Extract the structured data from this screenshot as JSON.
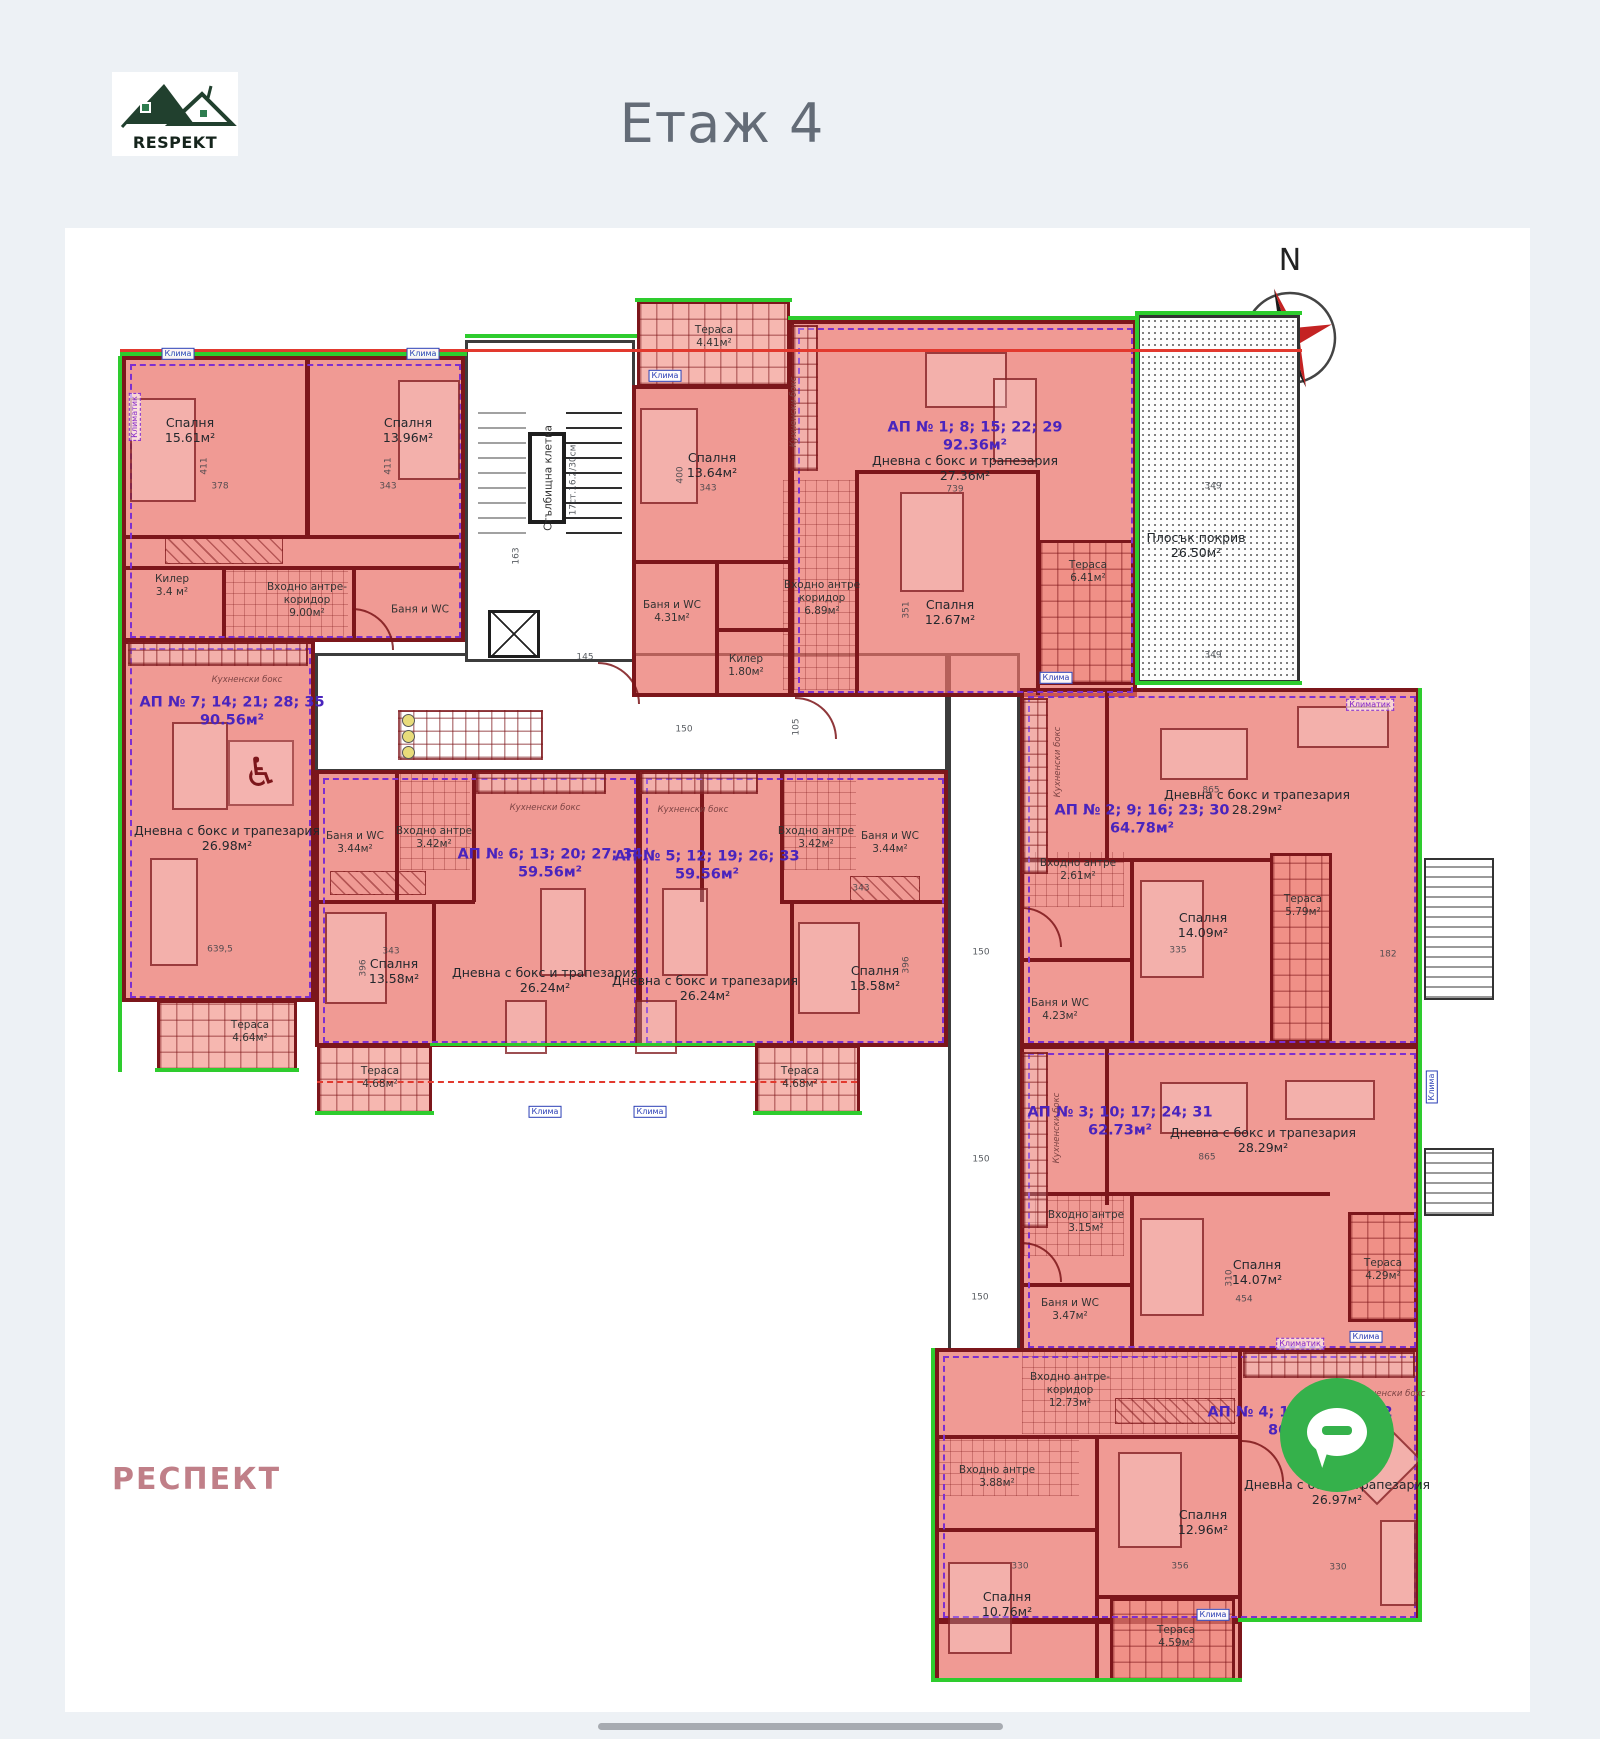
{
  "page": {
    "logo_text": "RESPEKT",
    "title": "Етаж 4",
    "watermark": "РЕСПЕКТ",
    "compass_letter": "N"
  },
  "floor_plan": {
    "apartments": [
      {
        "name": "АП № 7; 14; 21; 28; 35",
        "area": "90.56м²",
        "label": {
          "x": 232,
          "y": 712
        },
        "rooms": [
          {
            "t": [
              "Спалня",
              "15.61м²"
            ],
            "x": 190,
            "y": 430
          },
          {
            "t": [
              "Спалня",
              "13.96м²"
            ],
            "x": 408,
            "y": 430
          },
          {
            "t": [
              "Килер",
              "3.4 м²"
            ],
            "x": 172,
            "y": 586,
            "cls": "sm"
          },
          {
            "t": [
              "Входно антре-",
              "коридор",
              "9.00м²"
            ],
            "x": 307,
            "y": 600,
            "cls": "sm"
          },
          {
            "t": [
              "Баня и WC"
            ],
            "x": 420,
            "y": 610,
            "cls": "sm"
          },
          {
            "t": [
              "Кухненски бокс"
            ],
            "x": 247,
            "y": 680,
            "cls": "tiny"
          },
          {
            "t": [
              "Дневна с бокс и трапезария",
              "26.98м²"
            ],
            "x": 227,
            "y": 838
          },
          {
            "t": [
              "Тераса",
              "4.64м²"
            ],
            "x": 250,
            "y": 1032,
            "cls": "sm"
          }
        ]
      },
      {
        "name": "АП № 1; 8; 15; 22; 29",
        "area": "92.36м²",
        "label": {
          "x": 975,
          "y": 437
        },
        "rooms": [
          {
            "t": [
              "Тераса",
              "4.41м²"
            ],
            "x": 714,
            "y": 337,
            "cls": "sm"
          },
          {
            "t": [
              "Спалня",
              "13.64м²"
            ],
            "x": 712,
            "y": 465
          },
          {
            "t": [
              "Кухненски бокс"
            ],
            "x": 794,
            "y": 412,
            "cls": "tiny rot"
          },
          {
            "t": [
              "Дневна с бокс и трапезария",
              "27.36м²"
            ],
            "x": 965,
            "y": 468
          },
          {
            "t": [
              "Баня и WC",
              "4.31м²"
            ],
            "x": 672,
            "y": 612,
            "cls": "sm"
          },
          {
            "t": [
              "Килер",
              "1.80м²"
            ],
            "x": 746,
            "y": 666,
            "cls": "sm"
          },
          {
            "t": [
              "Входно антре",
              "коридор",
              "6.89м²"
            ],
            "x": 822,
            "y": 598,
            "cls": "sm"
          },
          {
            "t": [
              "Спалня",
              "12.67м²"
            ],
            "x": 950,
            "y": 612
          },
          {
            "t": [
              "Тераса",
              "6.41м²"
            ],
            "x": 1088,
            "y": 572,
            "cls": "sm"
          }
        ]
      },
      {
        "name": "АП № 2; 9; 16; 23; 30",
        "area": "64.78м²",
        "label": {
          "x": 1142,
          "y": 820
        },
        "rooms": [
          {
            "t": [
              "Кухненски бокс"
            ],
            "x": 1058,
            "y": 762,
            "cls": "tiny rot"
          },
          {
            "t": [
              "Дневна с бокс и трапезария",
              "28.29м²"
            ],
            "x": 1257,
            "y": 802
          },
          {
            "t": [
              "Входно антре",
              "2.61м²"
            ],
            "x": 1078,
            "y": 870,
            "cls": "sm"
          },
          {
            "t": [
              "Спалня",
              "14.09м²"
            ],
            "x": 1203,
            "y": 925
          },
          {
            "t": [
              "Баня и WC",
              "4.23м²"
            ],
            "x": 1060,
            "y": 1010,
            "cls": "sm"
          },
          {
            "t": [
              "Тераса",
              "5.79м²"
            ],
            "x": 1303,
            "y": 906,
            "cls": "sm"
          }
        ]
      },
      {
        "name": "АП № 3; 10; 17; 24; 31",
        "area": "62.73м²",
        "label": {
          "x": 1120,
          "y": 1122
        },
        "rooms": [
          {
            "t": [
              "Кухненски бокс"
            ],
            "x": 1057,
            "y": 1128,
            "cls": "tiny rot"
          },
          {
            "t": [
              "Дневна с бокс и трапезария",
              "28.29м²"
            ],
            "x": 1263,
            "y": 1140
          },
          {
            "t": [
              "Входно антре",
              "3.15м²"
            ],
            "x": 1086,
            "y": 1222,
            "cls": "sm"
          },
          {
            "t": [
              "Баня и WC",
              "3.47м²"
            ],
            "x": 1070,
            "y": 1310,
            "cls": "sm"
          },
          {
            "t": [
              "Спалня",
              "14.07м²"
            ],
            "x": 1257,
            "y": 1272
          },
          {
            "t": [
              "Тераса",
              "4.29м²"
            ],
            "x": 1383,
            "y": 1270,
            "cls": "sm"
          }
        ]
      },
      {
        "name": "АП № 4; 11; 18; 25; 32",
        "area": "86.20м²",
        "label": {
          "x": 1300,
          "y": 1422
        },
        "rooms": [
          {
            "t": [
              "Входно антре-",
              "коридор",
              "12.73м²"
            ],
            "x": 1070,
            "y": 1390,
            "cls": "sm"
          },
          {
            "t": [
              "Кухненски бокс"
            ],
            "x": 1390,
            "y": 1394,
            "cls": "tiny"
          },
          {
            "t": [
              "Дневна с бокс и трапезария",
              "26.97м²"
            ],
            "x": 1337,
            "y": 1492
          },
          {
            "t": [
              "Спалня",
              "12.96м²"
            ],
            "x": 1203,
            "y": 1522
          },
          {
            "t": [
              "Входно антре",
              "3.88м²"
            ],
            "x": 997,
            "y": 1477,
            "cls": "sm"
          },
          {
            "t": [
              "Спалня",
              "10.76м²"
            ],
            "x": 1007,
            "y": 1604
          },
          {
            "t": [
              "Тераса",
              "4.59м²"
            ],
            "x": 1176,
            "y": 1637,
            "cls": "sm"
          }
        ]
      },
      {
        "name": "АП № 5; 12; 19; 26; 33",
        "area": "59.56м²",
        "label": {
          "x": 707,
          "y": 866
        },
        "rooms": [
          {
            "t": [
              "Кухненски бокс"
            ],
            "x": 693,
            "y": 810,
            "cls": "tiny"
          },
          {
            "t": [
              "Входно антре",
              "3.42м²"
            ],
            "x": 816,
            "y": 838,
            "cls": "sm"
          },
          {
            "t": [
              "Баня и WC",
              "3.44м²"
            ],
            "x": 890,
            "y": 843,
            "cls": "sm"
          },
          {
            "t": [
              "Дневна с бокс и трапезария",
              "26.24м²"
            ],
            "x": 705,
            "y": 988
          },
          {
            "t": [
              "Спалня",
              "13.58м²"
            ],
            "x": 875,
            "y": 978
          },
          {
            "t": [
              "Тераса",
              "4.68м²"
            ],
            "x": 800,
            "y": 1078,
            "cls": "sm"
          }
        ]
      },
      {
        "name": "АП № 6; 13; 20; 27; 34",
        "area": "59.56м²",
        "label": {
          "x": 550,
          "y": 864
        },
        "rooms": [
          {
            "t": [
              "Кухненски бокс"
            ],
            "x": 545,
            "y": 808,
            "cls": "tiny"
          },
          {
            "t": [
              "Баня и WC",
              "3.44м²"
            ],
            "x": 355,
            "y": 843,
            "cls": "sm"
          },
          {
            "t": [
              "Входно антре",
              "3.42м²"
            ],
            "x": 434,
            "y": 838,
            "cls": "sm"
          },
          {
            "t": [
              "Спалня",
              "13.58м²"
            ],
            "x": 394,
            "y": 971
          },
          {
            "t": [
              "Дневна с бокс и трапезария",
              "26.24м²"
            ],
            "x": 545,
            "y": 980
          },
          {
            "t": [
              "Тераса",
              "4.68м²"
            ],
            "x": 380,
            "y": 1078,
            "cls": "sm"
          }
        ]
      }
    ],
    "misc": [
      {
        "t": [
          "Плосък покрив",
          "26.50м²"
        ],
        "x": 1196,
        "y": 545
      },
      {
        "t": [
          "Стълбищна клетка"
        ],
        "x": 549,
        "y": 478,
        "cls": "sm rot"
      },
      {
        "t": [
          "17ст.16.2/30см"
        ],
        "x": 574,
        "y": 480,
        "cls": "dim rot"
      }
    ],
    "hvac": [
      {
        "t": "Клима",
        "x": 178,
        "y": 354
      },
      {
        "t": "Клима",
        "x": 423,
        "y": 354
      },
      {
        "t": "Клима",
        "x": 665,
        "y": 376
      },
      {
        "t": "Клима",
        "x": 1056,
        "y": 678
      },
      {
        "t": "Клима",
        "x": 545,
        "y": 1112
      },
      {
        "t": "Клима",
        "x": 650,
        "y": 1112
      },
      {
        "t": "Клима",
        "x": 1432,
        "y": 1087,
        "r": 1
      },
      {
        "t": "Клима",
        "x": 1366,
        "y": 1337
      },
      {
        "t": "Клима",
        "x": 1213,
        "y": 1615
      },
      {
        "t": "Климатик",
        "x": 1370,
        "y": 705,
        "p": 1
      },
      {
        "t": "Климатик",
        "x": 135,
        "y": 417,
        "r": 1,
        "p": 1
      },
      {
        "t": "Климатик",
        "x": 1300,
        "y": 1344,
        "p": 1
      }
    ],
    "dims": [
      {
        "t": "378",
        "x": 220,
        "y": 487
      },
      {
        "t": "343",
        "x": 388,
        "y": 487
      },
      {
        "t": "411",
        "x": 205,
        "y": 466,
        "r": 1
      },
      {
        "t": "411",
        "x": 389,
        "y": 466,
        "r": 1
      },
      {
        "t": "343",
        "x": 708,
        "y": 489
      },
      {
        "t": "739",
        "x": 955,
        "y": 490
      },
      {
        "t": "400",
        "x": 681,
        "y": 475,
        "r": 1
      },
      {
        "t": "351",
        "x": 907,
        "y": 610,
        "r": 1
      },
      {
        "t": "349",
        "x": 1213,
        "y": 487
      },
      {
        "t": "349",
        "x": 1213,
        "y": 656
      },
      {
        "t": "182",
        "x": 1388,
        "y": 955
      },
      {
        "t": "865",
        "x": 1211,
        "y": 791
      },
      {
        "t": "335",
        "x": 1178,
        "y": 951
      },
      {
        "t": "865",
        "x": 1207,
        "y": 1158
      },
      {
        "t": "454",
        "x": 1244,
        "y": 1300
      },
      {
        "t": "310",
        "x": 1230,
        "y": 1278,
        "r": 1
      },
      {
        "t": "150",
        "x": 981,
        "y": 953
      },
      {
        "t": "150",
        "x": 981,
        "y": 1160
      },
      {
        "t": "150",
        "x": 980,
        "y": 1298
      },
      {
        "t": "150",
        "x": 684,
        "y": 730
      },
      {
        "t": "105",
        "x": 797,
        "y": 727,
        "r": 1
      },
      {
        "t": "145",
        "x": 585,
        "y": 658
      },
      {
        "t": "163",
        "x": 517,
        "y": 556,
        "r": 1
      },
      {
        "t": "330",
        "x": 1020,
        "y": 1567
      },
      {
        "t": "356",
        "x": 1180,
        "y": 1567
      },
      {
        "t": "330",
        "x": 1338,
        "y": 1568
      },
      {
        "t": "450",
        "x": 1366,
        "y": 1453
      },
      {
        "t": "343",
        "x": 391,
        "y": 952
      },
      {
        "t": "396",
        "x": 364,
        "y": 968,
        "r": 1
      },
      {
        "t": "343",
        "x": 861,
        "y": 889
      },
      {
        "t": "396",
        "x": 907,
        "y": 965,
        "r": 1
      },
      {
        "t": "639,5",
        "x": 220,
        "y": 950
      }
    ]
  }
}
